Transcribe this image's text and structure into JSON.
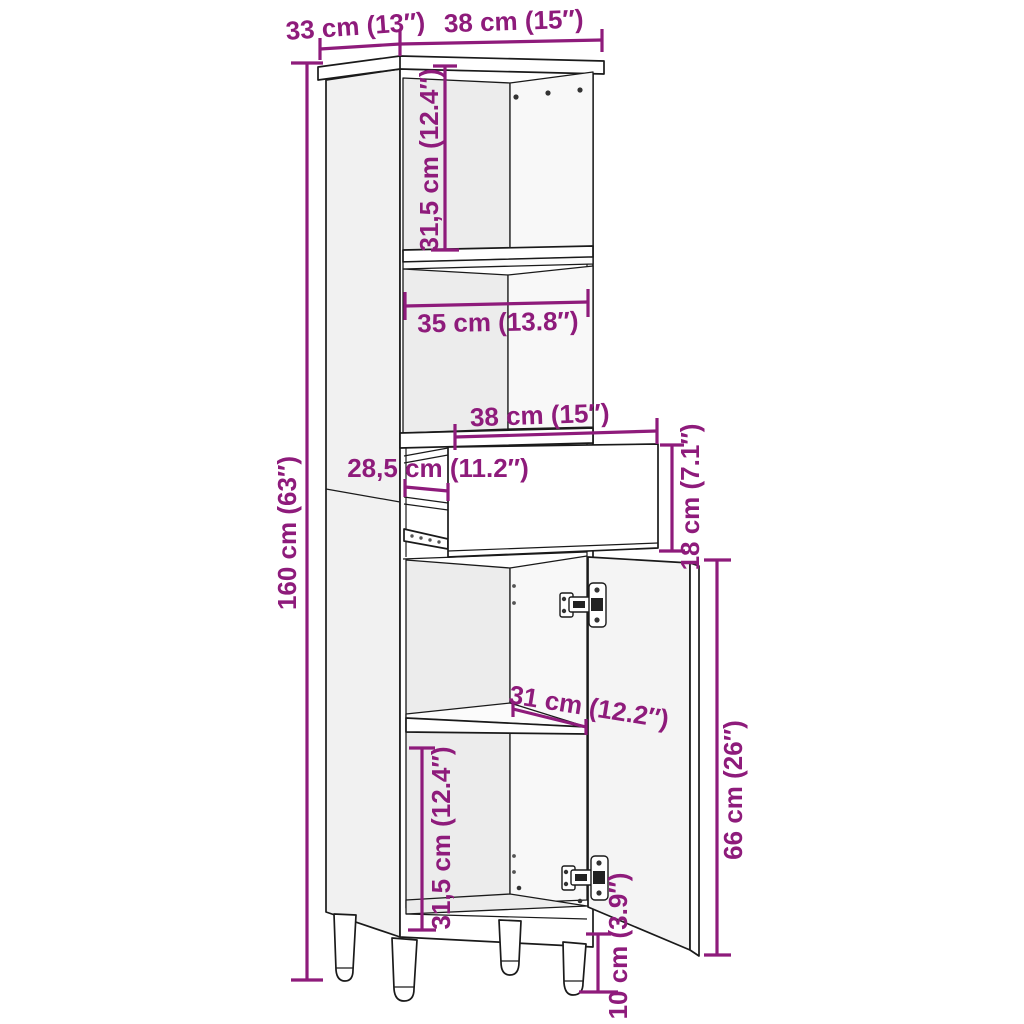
{
  "page": {
    "title": "Bathroom cabinet dimension diagram",
    "background_color": "#ffffff"
  },
  "diagram": {
    "type": "furniture-dimension-drawing",
    "subject": "tall bathroom cabinet with open shelves, pull-out drawer and open door",
    "style": {
      "dimension_color": "#8E1B7B",
      "outline_color": "#1a1a1a"
    },
    "labels": {
      "depth": "33 cm (13″)",
      "width": "38 cm (15″)",
      "upper_compartment_height": "31,5 cm (12.4″)",
      "inner_width": "35 cm (13.8″)",
      "drawer_width": "38 cm (15″)",
      "drawer_extension": "28,5 cm (11.2″)",
      "drawer_front_height": "18 cm (7.1″)",
      "total_height": "160 cm (63″)",
      "shelf_depth": "31 cm (12.2″)",
      "door_height": "66 cm (26″)",
      "lower_compartment_height": "31,5 cm (12.4″)",
      "leg_height": "10 cm (3.9″)"
    }
  }
}
